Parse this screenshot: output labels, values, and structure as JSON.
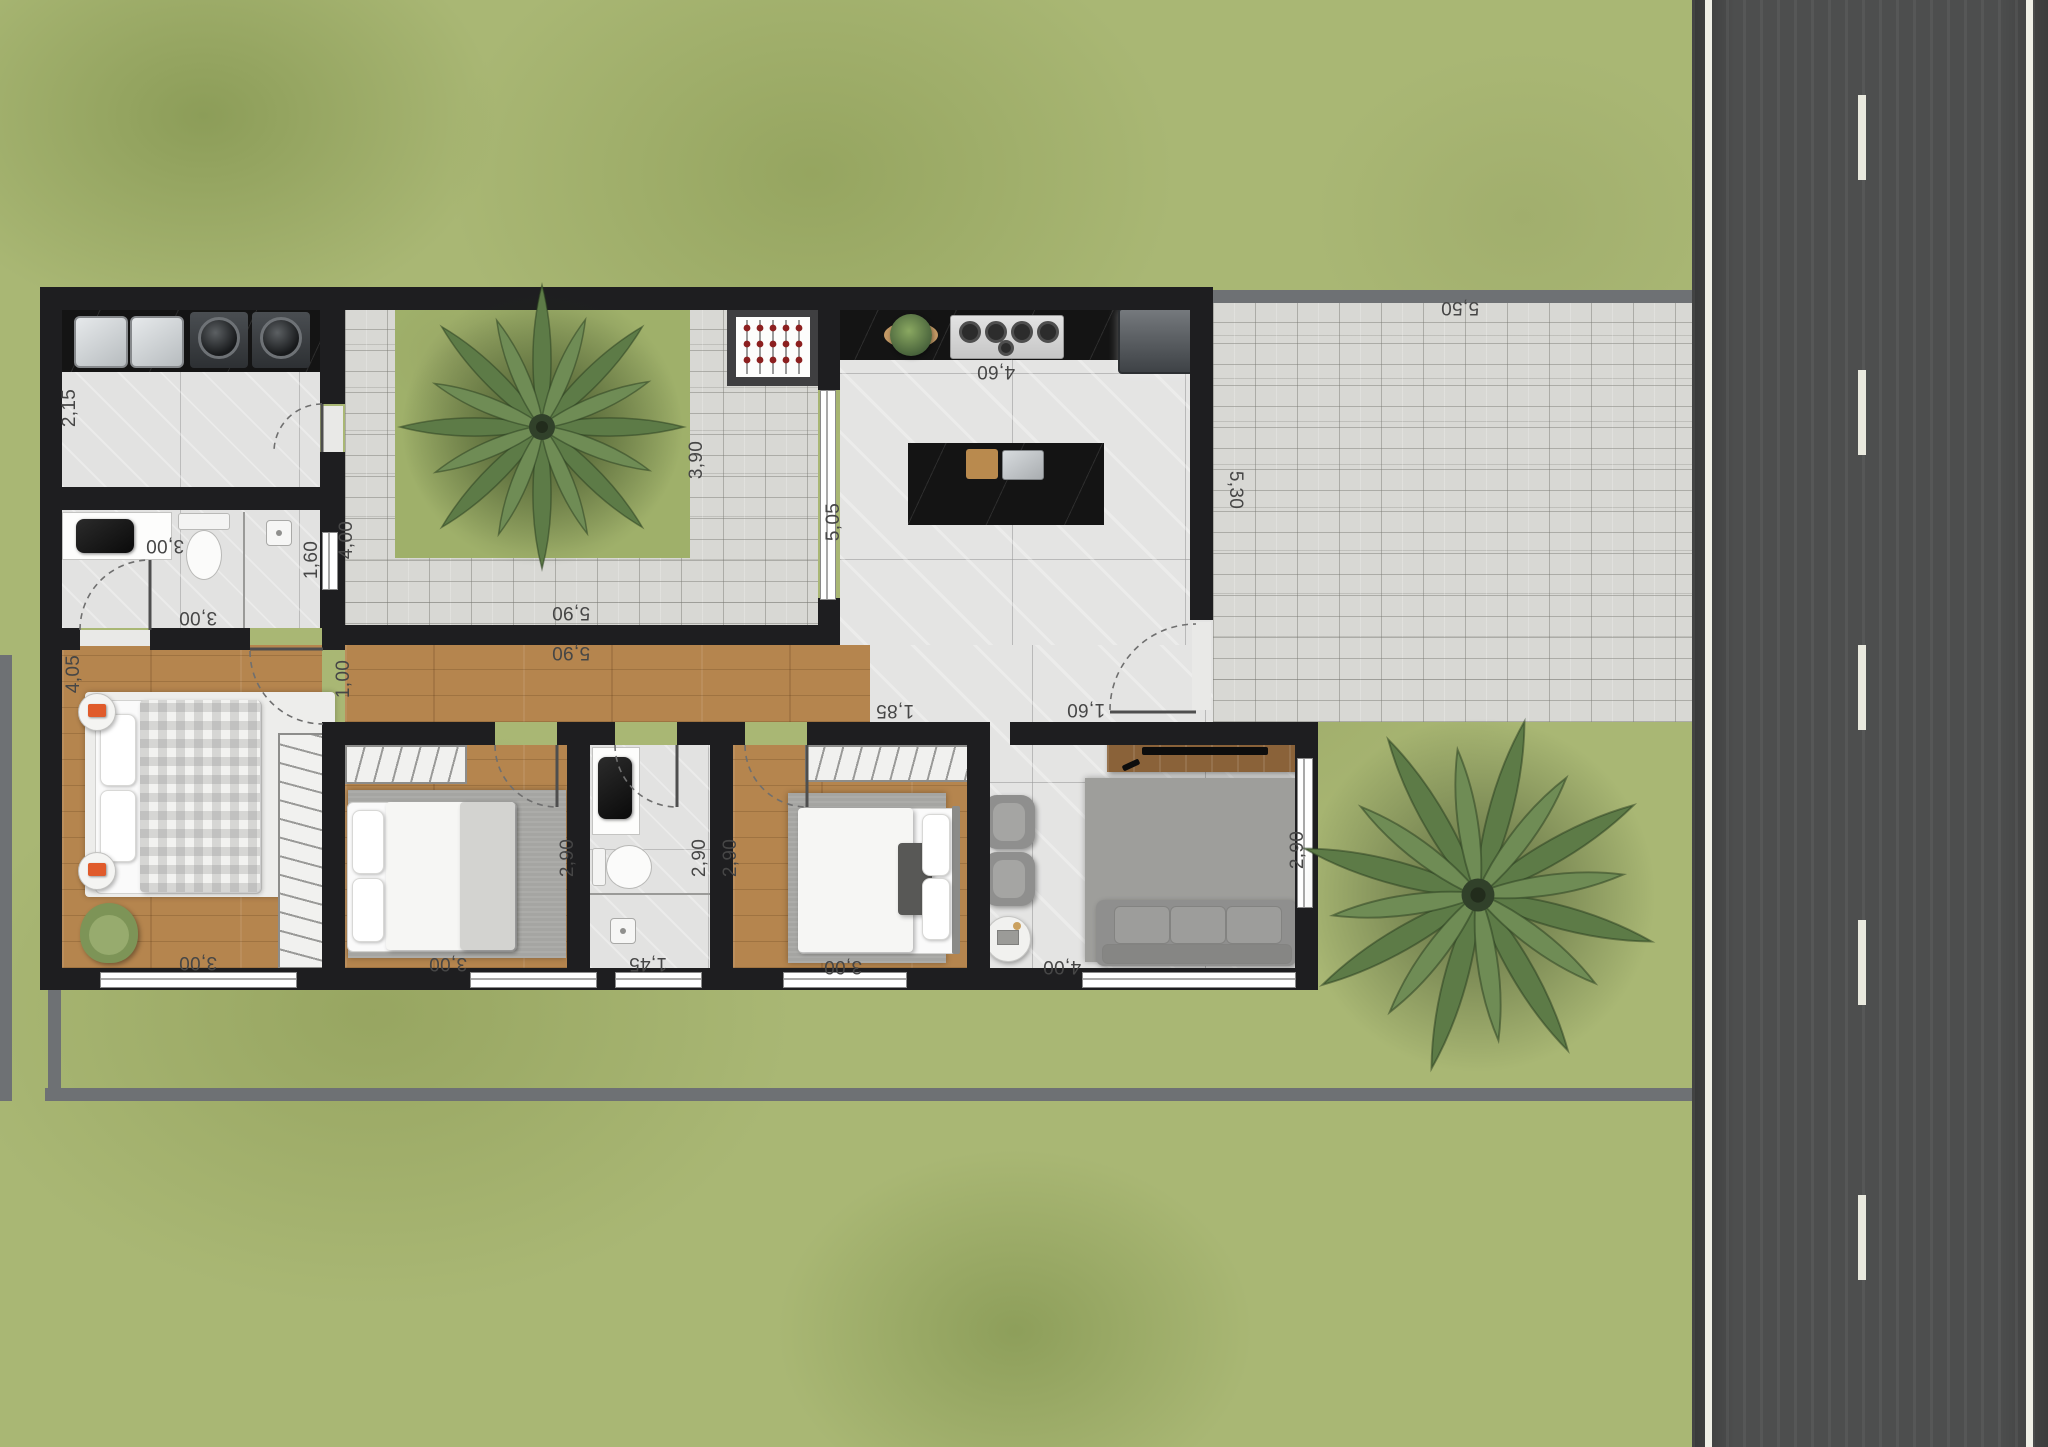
{
  "scene": {
    "kind": "residential floor plan, rendered top view",
    "canvas": {
      "width": 2048,
      "height": 1447
    },
    "units": "meters (comma decimal)"
  },
  "dimension_labels": [
    {
      "id": "service-depth",
      "text": "2,15"
    },
    {
      "id": "service-width",
      "text": "3,00"
    },
    {
      "id": "courtyard-walk-depth",
      "text": "4,00"
    },
    {
      "id": "courtyard-walk-width",
      "text": "3,90"
    },
    {
      "id": "courtyard-paving-len",
      "text": "5,90"
    },
    {
      "id": "hallway-length",
      "text": "5,90"
    },
    {
      "id": "bathroom1-shower",
      "text": "1,60"
    },
    {
      "id": "bathroom1-width",
      "text": "3,00"
    },
    {
      "id": "master-bedroom-depth",
      "text": "4,05"
    },
    {
      "id": "hallway-width",
      "text": "1,00"
    },
    {
      "id": "master-bedroom-width",
      "text": "3,00"
    },
    {
      "id": "bedroom2-depth",
      "text": "2,90"
    },
    {
      "id": "bedroom2-width",
      "text": "3,00"
    },
    {
      "id": "bathroom2-width",
      "text": "1,45"
    },
    {
      "id": "bathroom2-depth",
      "text": "2,90"
    },
    {
      "id": "bedroom3-depth",
      "text": "2,90"
    },
    {
      "id": "bedroom3-width",
      "text": "3,00"
    },
    {
      "id": "passage-width",
      "text": "1,85"
    },
    {
      "id": "patio-door-width",
      "text": "1,60"
    },
    {
      "id": "kitchen-width",
      "text": "4,60"
    },
    {
      "id": "kitchen-depth",
      "text": "5,05"
    },
    {
      "id": "living-width",
      "text": "4,00"
    },
    {
      "id": "living-window-width",
      "text": "2,90"
    },
    {
      "id": "patio-depth",
      "text": "5,30"
    },
    {
      "id": "patio-width",
      "text": "5,50"
    }
  ],
  "rooms": [
    {
      "name": "laundry-service-area",
      "furniture": [
        "double-laundry-tub",
        "washer",
        "dryer"
      ]
    },
    {
      "name": "bathroom-1",
      "furniture": [
        "vanity-with-black-sink",
        "toilet",
        "shower"
      ]
    },
    {
      "name": "internal-courtyard",
      "furniture": [
        "palm-tree",
        "barbecue-grill",
        "lawn-square"
      ]
    },
    {
      "name": "kitchen-dining",
      "furniture": [
        "black-countertop",
        "gas-cooktop",
        "potted-plant",
        "refrigerator",
        "island-with-sink",
        "four-bar-stools"
      ]
    },
    {
      "name": "hallway",
      "furniture": []
    },
    {
      "name": "master-bedroom",
      "furniture": [
        "double-bed",
        "two-round-nightstands",
        "green-armchair",
        "wardrobe",
        "white-rug"
      ]
    },
    {
      "name": "bedroom-2",
      "furniture": [
        "bed",
        "gray-rug",
        "wardrobe"
      ]
    },
    {
      "name": "bathroom-2",
      "furniture": [
        "vanity-with-black-sink",
        "toilet",
        "shower"
      ]
    },
    {
      "name": "bedroom-3",
      "furniture": [
        "bed",
        "gray-rug",
        "wardrobe"
      ]
    },
    {
      "name": "living-room",
      "furniture": [
        "three-seat-sofa",
        "two-armchairs",
        "round-side-table",
        "tv-console",
        "gray-rug"
      ]
    },
    {
      "name": "side-patio",
      "furniture": []
    },
    {
      "name": "front-lawn",
      "furniture": [
        "palm-tree"
      ]
    },
    {
      "name": "street",
      "furniture": [
        "dashed-lane-marking"
      ]
    }
  ],
  "colors": {
    "lawn": "#a9b774",
    "road": "#4d4e4e",
    "road_marking": "#efefe6",
    "wall": "#1e1e20",
    "boundary_wall": "#6e7174",
    "wood_floor": "#b5854e",
    "tile_floor": "#e4e4e3",
    "paver": "#d8d8d4",
    "black_counter": "#141414",
    "label_text": "#464646",
    "stool": "#e7cf9f",
    "sofa": "#8f8f8e",
    "accent_orange": "#e05b2b",
    "palm_green": "#5d7b47"
  }
}
